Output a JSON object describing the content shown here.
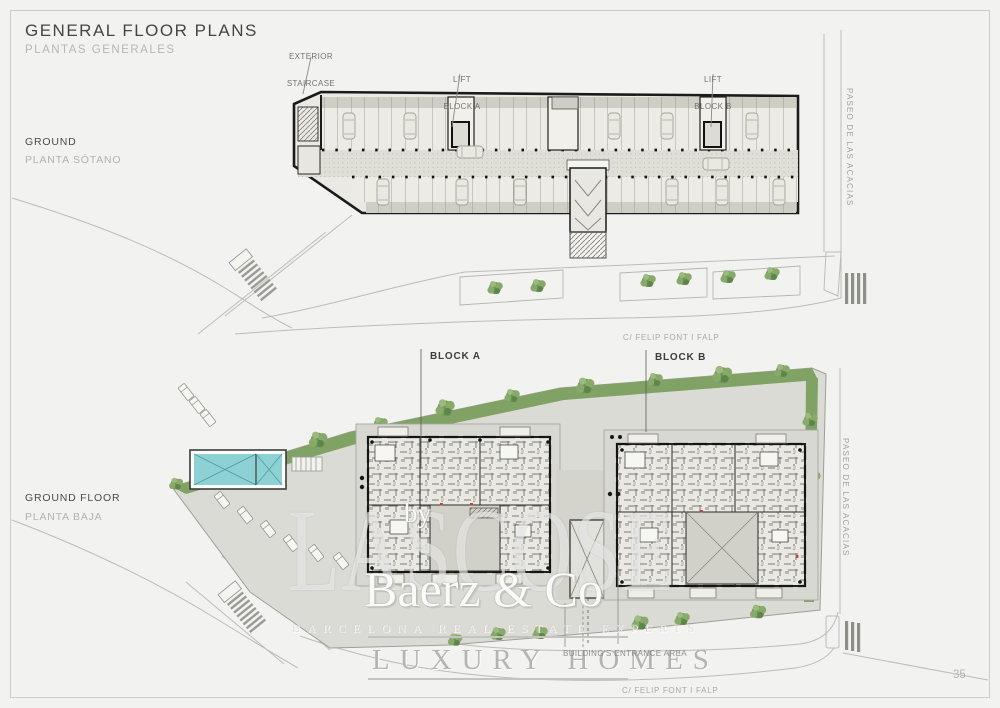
{
  "header": {
    "title": "GENERAL FLOOR PLANS",
    "subtitle": "PLANTAS GENERALES"
  },
  "basement_plan": {
    "label": "GROUND",
    "label_es": "PLANTA SÓTANO",
    "callout_exterior_staircase_1": "EXTERIOR",
    "callout_exterior_staircase_2": "STAIRCASE",
    "callout_lift_a_1": "LIFT",
    "callout_lift_a_2": "BLOCK A",
    "callout_lift_b_1": "LIFT",
    "callout_lift_b_2": "BLOCK B",
    "street_right": "PASEO DE LAS ACACIAS",
    "street_bottom": "C/ FELIP FONT I FALP"
  },
  "ground_floor_plan": {
    "label": "GROUND FLOOR",
    "label_es": "PLANTA BAJA",
    "callout_block_a": "BLOCK A",
    "callout_block_b": "BLOCK B",
    "callout_entrance": "BUILDING'S ENTRANCE AREA",
    "street_right": "PASEO DE LAS ACACIAS",
    "street_bottom": "C/ FELIP FONT I FALP"
  },
  "watermark": {
    "background_letters": "LASCOSE",
    "by": "by",
    "brand": "Baerz & Co",
    "tagline": "BARCELONA REAL ESTATE EXPERTS",
    "line": "LUXURY HOMES"
  },
  "page": {
    "number": "35"
  },
  "colors": {
    "background": "#f2f2f0",
    "plan_line": "#1b1b19",
    "green": "#7d9e62",
    "pool_water": "#8ed1d4",
    "muted_text": "#b1b1ae",
    "dark_text": "#454543"
  }
}
